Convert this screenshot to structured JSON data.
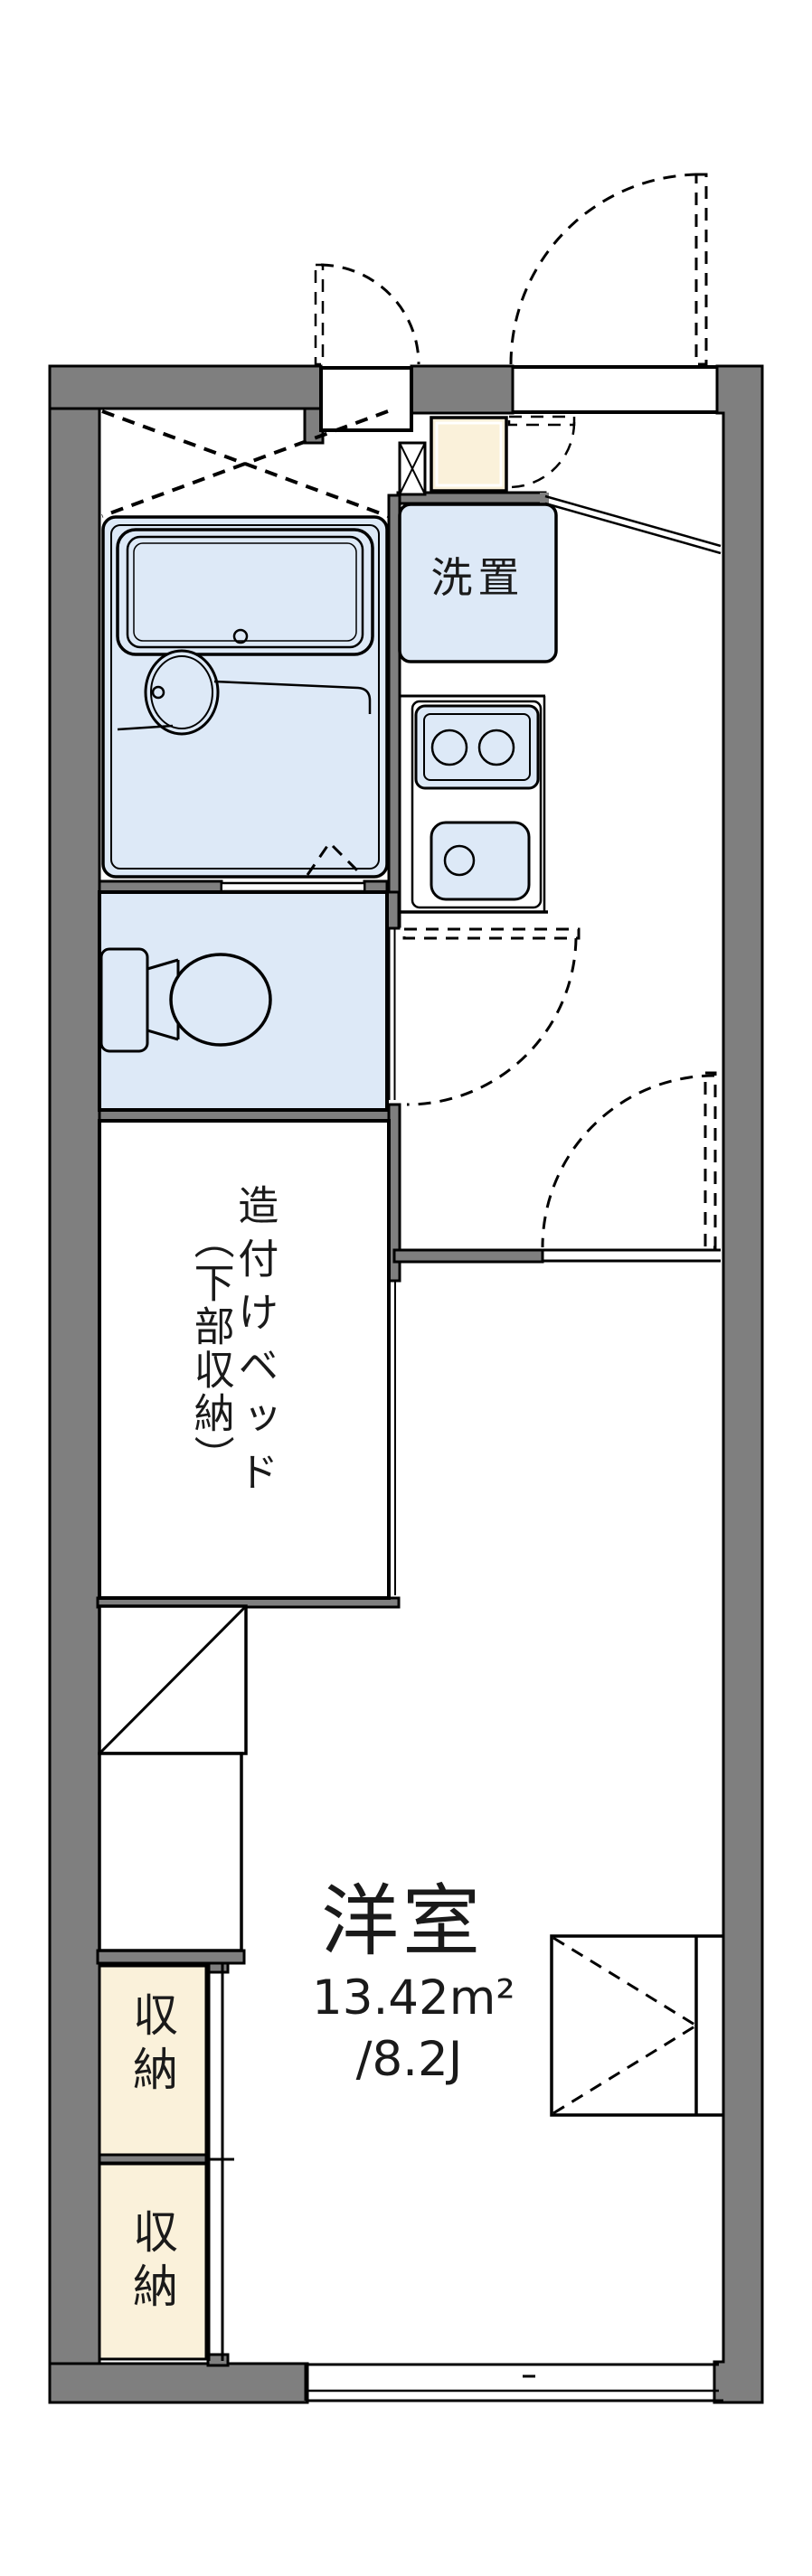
{
  "floorplan": {
    "labels": {
      "washer": "洗置",
      "bed_line1": "造付けベッド",
      "bed_line2": "（下部収納）",
      "closet_upper": "収納",
      "closet_lower": "収納",
      "room": "洋室",
      "area": "13.42m²",
      "size": "/8.2J"
    },
    "colors": {
      "wall": "#7f7f7f",
      "fixture_blue": "#dde9f7",
      "storage_cream": "#faf1da",
      "line": "#000000",
      "bg": "#ffffff"
    }
  }
}
